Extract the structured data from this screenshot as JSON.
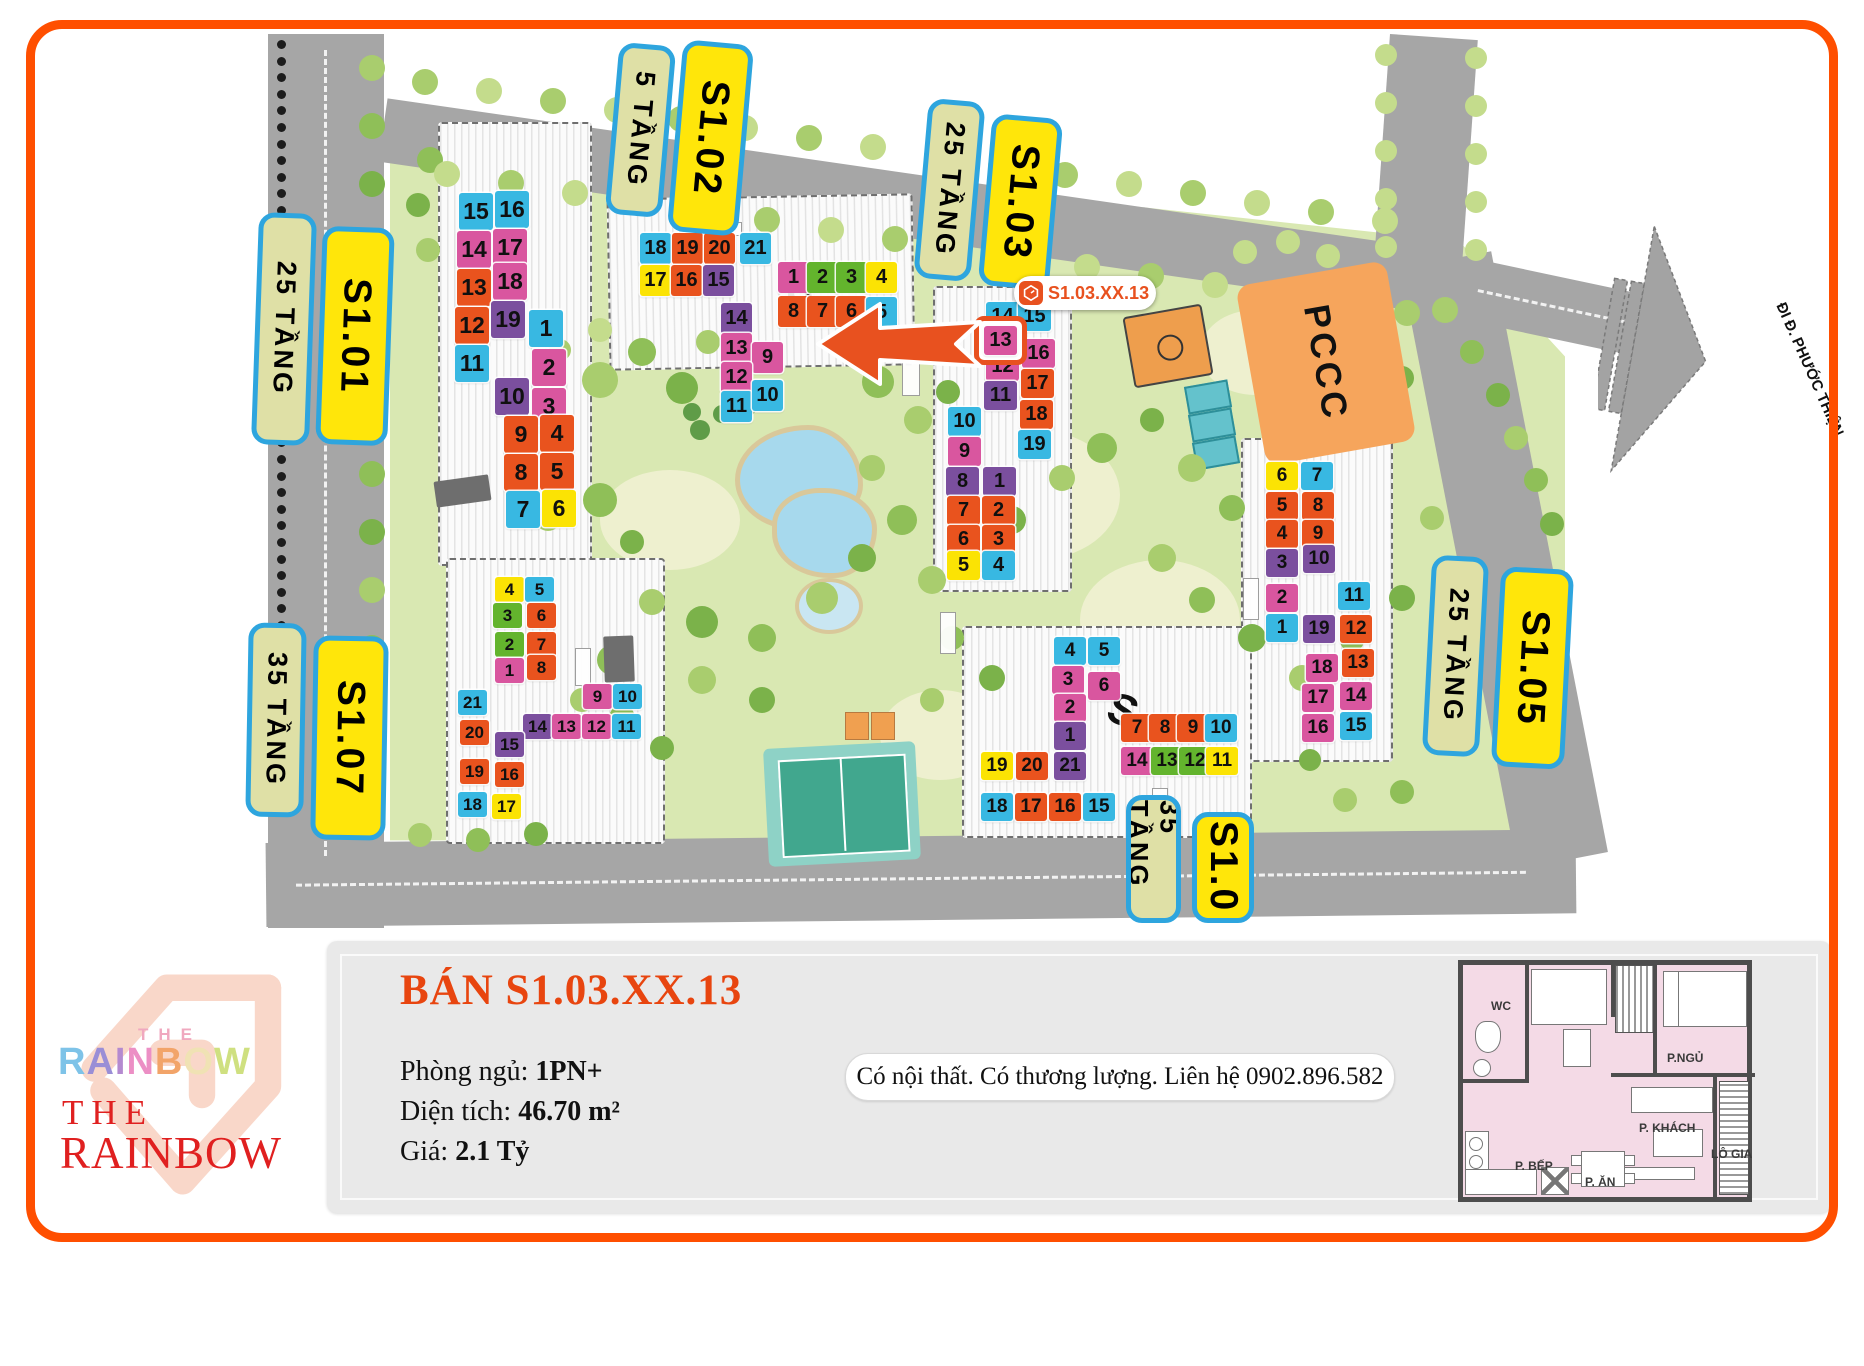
{
  "frame": {
    "border_color": "#ff4f00"
  },
  "map": {
    "road_destination_label": "ĐI Đ. PHƯỚC THIỆN",
    "pccc_label": "PCCC",
    "site_marks": [
      "S",
      "S"
    ],
    "callout": {
      "icon": "rainbow-logo-icon",
      "text": "S1.03.XX.13"
    },
    "highlighted_unit": {
      "building": "S1.03",
      "unit": 13
    },
    "unit_colors": {
      "cyan": "#38b8e2",
      "magenta": "#d9569f",
      "orange": "#e9531e",
      "purple": "#7b4f9e",
      "yellow": "#fbe304",
      "green": "#63b42d"
    },
    "labels": [
      {
        "id": "floors-s101",
        "text": "25 TẦNG",
        "style": "tan",
        "x": 255,
        "y": 213,
        "w": 58,
        "h": 232,
        "rot": 2
      },
      {
        "id": "name-s101",
        "text": "S1.01",
        "style": "yellow",
        "x": 319,
        "y": 227,
        "w": 72,
        "h": 218,
        "rot": 2
      },
      {
        "id": "floors-s102",
        "text": "5 TẦNG",
        "style": "tan",
        "x": 612,
        "y": 44,
        "w": 57,
        "h": 172,
        "rot": 5
      },
      {
        "id": "name-s102",
        "text": "S1.02",
        "style": "yellow",
        "x": 675,
        "y": 42,
        "w": 71,
        "h": 192,
        "rot": 5
      },
      {
        "id": "floors-s103",
        "text": "25 TẦNG",
        "style": "tan",
        "x": 921,
        "y": 100,
        "w": 57,
        "h": 180,
        "rot": 5
      },
      {
        "id": "name-s103",
        "text": "S1.03",
        "style": "yellow",
        "x": 985,
        "y": 116,
        "w": 71,
        "h": 172,
        "rot": 5
      },
      {
        "id": "floors-s105",
        "text": "25 TẦNG",
        "style": "tan",
        "x": 1427,
        "y": 556,
        "w": 57,
        "h": 200,
        "rot": 3
      },
      {
        "id": "name-s105",
        "text": "S1.05",
        "style": "yellow",
        "x": 1496,
        "y": 568,
        "w": 73,
        "h": 200,
        "rot": 3
      },
      {
        "id": "floors-s107",
        "text": "35 TẦNG",
        "style": "tan",
        "x": 247,
        "y": 623,
        "w": 58,
        "h": 194,
        "rot": 1
      },
      {
        "id": "name-s107",
        "text": "S1.07",
        "style": "yellow",
        "x": 312,
        "y": 636,
        "w": 75,
        "h": 204,
        "rot": 1
      },
      {
        "id": "floors-s104",
        "text": "35 TẦNG",
        "style": "tan",
        "x": 1126,
        "y": 795,
        "w": 55,
        "h": 128,
        "rot": 0
      },
      {
        "id": "name-s104",
        "text": "S1.0",
        "style": "yellow",
        "x": 1192,
        "y": 812,
        "w": 62,
        "h": 111,
        "rot": 0
      }
    ],
    "buildings": [
      {
        "name": "S1.01",
        "cell": {
          "w": 34,
          "h": 37,
          "f": 23
        },
        "units": [
          [
            15,
            "cyan",
            459,
            193
          ],
          [
            16,
            "cyan",
            495,
            191
          ],
          [
            14,
            "magenta",
            457,
            231
          ],
          [
            17,
            "magenta",
            493,
            229
          ],
          [
            13,
            "orange",
            457,
            269
          ],
          [
            18,
            "magenta",
            493,
            263
          ],
          [
            12,
            "orange",
            455,
            307
          ],
          [
            19,
            "purple",
            491,
            301
          ],
          [
            11,
            "cyan",
            455,
            345
          ],
          [
            1,
            "cyan",
            529,
            310
          ],
          [
            2,
            "magenta",
            532,
            349
          ],
          [
            10,
            "purple",
            495,
            378
          ],
          [
            3,
            "magenta",
            532,
            388
          ],
          [
            9,
            "orange",
            504,
            416
          ],
          [
            4,
            "orange",
            540,
            415
          ],
          [
            8,
            "orange",
            504,
            454
          ],
          [
            5,
            "orange",
            540,
            453
          ],
          [
            7,
            "cyan",
            506,
            491
          ],
          [
            6,
            "yellow",
            542,
            490
          ]
        ]
      },
      {
        "name": "S1.02",
        "cell": {
          "w": 31,
          "h": 31,
          "f": 20
        },
        "units": [
          [
            18,
            "cyan",
            640,
            233
          ],
          [
            19,
            "orange",
            672,
            233
          ],
          [
            20,
            "orange",
            704,
            233
          ],
          [
            21,
            "cyan",
            740,
            233
          ],
          [
            17,
            "yellow",
            640,
            265
          ],
          [
            16,
            "orange",
            671,
            265
          ],
          [
            15,
            "purple",
            703,
            265
          ],
          [
            14,
            "purple",
            721,
            303
          ],
          [
            13,
            "magenta",
            721,
            333
          ],
          [
            9,
            "magenta",
            752,
            342
          ],
          [
            12,
            "magenta",
            721,
            362
          ],
          [
            11,
            "cyan",
            721,
            391
          ],
          [
            10,
            "cyan",
            752,
            380
          ],
          [
            1,
            "magenta",
            778,
            262
          ],
          [
            2,
            "green",
            807,
            262
          ],
          [
            3,
            "green",
            836,
            262
          ],
          [
            4,
            "yellow",
            866,
            262
          ],
          [
            8,
            "orange",
            778,
            296
          ],
          [
            7,
            "orange",
            807,
            296
          ],
          [
            6,
            "orange",
            836,
            296
          ],
          [
            5,
            "cyan",
            866,
            297
          ]
        ]
      },
      {
        "name": "S1.03",
        "cell": {
          "w": 33,
          "h": 29,
          "f": 20
        },
        "units": [
          [
            14,
            "cyan",
            986,
            302
          ],
          [
            15,
            "cyan",
            1018,
            302
          ],
          [
            13,
            "magenta",
            984,
            326,
            1
          ],
          [
            16,
            "magenta",
            1022,
            339
          ],
          [
            12,
            "magenta",
            986,
            352
          ],
          [
            17,
            "orange",
            1021,
            369
          ],
          [
            11,
            "purple",
            984,
            381
          ],
          [
            18,
            "orange",
            1020,
            400
          ],
          [
            10,
            "cyan",
            948,
            407
          ],
          [
            19,
            "cyan",
            1018,
            430
          ],
          [
            9,
            "magenta",
            948,
            437
          ],
          [
            8,
            "purple",
            946,
            467
          ],
          [
            1,
            "purple",
            983,
            467
          ],
          [
            7,
            "orange",
            947,
            496
          ],
          [
            2,
            "orange",
            982,
            496
          ],
          [
            6,
            "orange",
            947,
            525
          ],
          [
            3,
            "orange",
            982,
            525
          ],
          [
            5,
            "yellow",
            947,
            551
          ],
          [
            4,
            "cyan",
            982,
            551
          ]
        ]
      },
      {
        "name": "S1.05",
        "cell": {
          "w": 32,
          "h": 28,
          "f": 19
        },
        "units": [
          [
            6,
            "yellow",
            1266,
            462
          ],
          [
            7,
            "cyan",
            1301,
            462
          ],
          [
            5,
            "orange",
            1266,
            492
          ],
          [
            8,
            "orange",
            1302,
            492
          ],
          [
            4,
            "orange",
            1266,
            520
          ],
          [
            9,
            "orange",
            1302,
            520
          ],
          [
            3,
            "purple",
            1266,
            549
          ],
          [
            10,
            "purple",
            1303,
            545
          ],
          [
            2,
            "magenta",
            1266,
            584
          ],
          [
            11,
            "cyan",
            1338,
            582
          ],
          [
            1,
            "cyan",
            1266,
            614
          ],
          [
            19,
            "purple",
            1303,
            615
          ],
          [
            12,
            "orange",
            1340,
            615
          ],
          [
            18,
            "magenta",
            1306,
            654
          ],
          [
            13,
            "orange",
            1342,
            649
          ],
          [
            17,
            "magenta",
            1302,
            684
          ],
          [
            14,
            "magenta",
            1340,
            682
          ],
          [
            16,
            "magenta",
            1302,
            714
          ],
          [
            15,
            "cyan",
            1340,
            712
          ]
        ]
      },
      {
        "name": "S1.06",
        "cell": {
          "w": 32,
          "h": 28,
          "f": 19
        },
        "units": [
          [
            4,
            "cyan",
            1054,
            637
          ],
          [
            5,
            "cyan",
            1088,
            637
          ],
          [
            3,
            "magenta",
            1052,
            666
          ],
          [
            6,
            "magenta",
            1088,
            672
          ],
          [
            2,
            "magenta",
            1054,
            694
          ],
          [
            1,
            "purple",
            1054,
            722
          ],
          [
            19,
            "yellow",
            981,
            752
          ],
          [
            20,
            "orange",
            1016,
            752
          ],
          [
            21,
            "purple",
            1054,
            752
          ],
          [
            18,
            "cyan",
            981,
            793
          ],
          [
            17,
            "orange",
            1015,
            793
          ],
          [
            16,
            "orange",
            1049,
            793
          ],
          [
            15,
            "cyan",
            1083,
            793
          ],
          [
            7,
            "orange",
            1121,
            714
          ],
          [
            8,
            "orange",
            1149,
            714
          ],
          [
            9,
            "orange",
            1177,
            714
          ],
          [
            10,
            "cyan",
            1205,
            714
          ],
          [
            14,
            "magenta",
            1121,
            747
          ],
          [
            13,
            "green",
            1151,
            747
          ],
          [
            12,
            "green",
            1179,
            747
          ],
          [
            11,
            "yellow",
            1206,
            747
          ]
        ]
      },
      {
        "name": "S1.07",
        "cell": {
          "w": 29,
          "h": 25,
          "f": 17
        },
        "units": [
          [
            4,
            "yellow",
            495,
            577
          ],
          [
            5,
            "cyan",
            525,
            577
          ],
          [
            3,
            "green",
            493,
            603
          ],
          [
            6,
            "orange",
            527,
            603
          ],
          [
            2,
            "green",
            495,
            632
          ],
          [
            7,
            "orange",
            527,
            632
          ],
          [
            1,
            "magenta",
            495,
            658
          ],
          [
            8,
            "orange",
            527,
            655
          ],
          [
            9,
            "magenta",
            583,
            684
          ],
          [
            10,
            "cyan",
            613,
            684
          ],
          [
            14,
            "purple",
            523,
            714
          ],
          [
            13,
            "magenta",
            552,
            714
          ],
          [
            12,
            "magenta",
            582,
            714
          ],
          [
            11,
            "cyan",
            612,
            714
          ],
          [
            21,
            "cyan",
            458,
            690
          ],
          [
            20,
            "orange",
            460,
            720
          ],
          [
            15,
            "purple",
            495,
            732
          ],
          [
            19,
            "orange",
            460,
            759
          ],
          [
            16,
            "orange",
            495,
            762
          ],
          [
            18,
            "cyan",
            458,
            792
          ],
          [
            17,
            "yellow",
            492,
            794
          ]
        ]
      }
    ]
  },
  "listing": {
    "title": "BÁN S1.03.XX.13",
    "rows": [
      {
        "label": "Phòng ngủ: ",
        "value": "1PN+"
      },
      {
        "label": "Diện tích: ",
        "value": "46.70 m²"
      },
      {
        "label": "Giá: ",
        "value": "2.1 Tỷ"
      }
    ],
    "note": "Có nội thất. Có thương lượng. Liên hệ 0902.896.582"
  },
  "logo": {
    "top_word": "THE",
    "top_name": "RAINBOW",
    "bottom_word": "THE",
    "bottom_name": "RAINBOW"
  },
  "floorplan": {
    "rooms": [
      {
        "id": "wc",
        "label": "WC",
        "x": 28,
        "y": 34
      },
      {
        "id": "bedroom",
        "label": "P.NGỦ",
        "x": 204,
        "y": 86
      },
      {
        "id": "living",
        "label": "P. KHÁCH",
        "x": 176,
        "y": 156
      },
      {
        "id": "kitchen",
        "label": "P. BẾP",
        "x": 52,
        "y": 194
      },
      {
        "id": "dining",
        "label": "P. ĂN",
        "x": 122,
        "y": 210
      },
      {
        "id": "loggia",
        "label": "LÔ GIA",
        "x": 248,
        "y": 182
      }
    ]
  }
}
